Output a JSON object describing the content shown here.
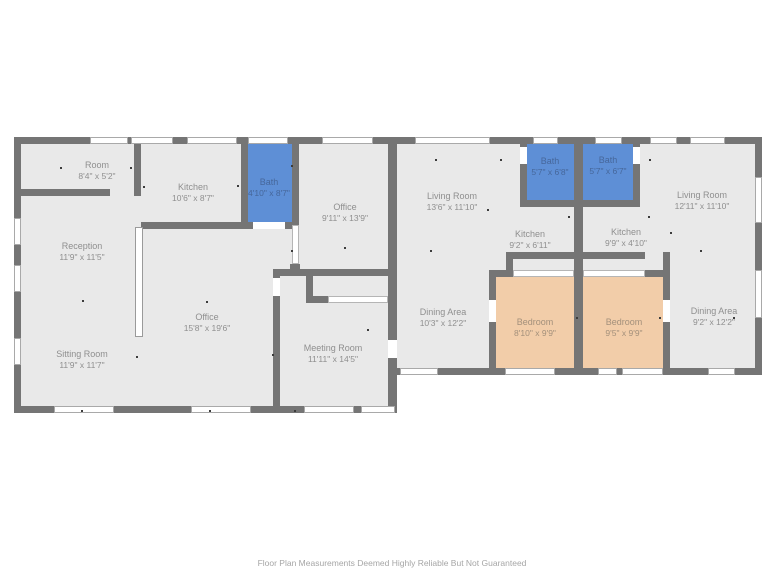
{
  "disclaimer": "Floor Plan Measurements Deemed Highly Reliable But Not Guaranteed",
  "colors": {
    "wall": "#757575",
    "floor": "#e9e9e9",
    "bath_fill": "#5e8fd6",
    "bedroom_fill": "#f2cda9",
    "label_text": "#8f8f8f",
    "bath_label_text": "#46679b",
    "bedroom_label_text": "#a3907b"
  },
  "rooms": [
    {
      "name": "Room",
      "dims": "8'4\" x 5'2\"",
      "x": 97,
      "y": 171,
      "style": "default"
    },
    {
      "name": "Kitchen",
      "dims": "10'6\" x 8'7\"",
      "x": 193,
      "y": 193,
      "style": "default"
    },
    {
      "name": "Bath",
      "dims": "4'10\" x 8'7\"",
      "x": 269,
      "y": 188,
      "style": "bath"
    },
    {
      "name": "Office",
      "dims": "9'11\" x 13'9\"",
      "x": 345,
      "y": 213,
      "style": "default"
    },
    {
      "name": "Reception",
      "dims": "11'9\" x 11'5\"",
      "x": 82,
      "y": 252,
      "style": "default"
    },
    {
      "name": "Office",
      "dims": "15'8\" x 19'6\"",
      "x": 207,
      "y": 323,
      "style": "default"
    },
    {
      "name": "Sitting Room",
      "dims": "11'9\" x 11'7\"",
      "x": 82,
      "y": 360,
      "style": "default"
    },
    {
      "name": "Meeting Room",
      "dims": "11'11\" x 14'5\"",
      "x": 333,
      "y": 354,
      "style": "default"
    },
    {
      "name": "Living Room",
      "dims": "13'6\" x 11'10\"",
      "x": 452,
      "y": 202,
      "style": "default"
    },
    {
      "name": "Bath",
      "dims": "5'7\" x 6'8\"",
      "x": 550,
      "y": 167,
      "style": "bath"
    },
    {
      "name": "Bath",
      "dims": "5'7\" x 6'7\"",
      "x": 608,
      "y": 166,
      "style": "bath"
    },
    {
      "name": "Living Room",
      "dims": "12'11\" x 11'10\"",
      "x": 702,
      "y": 201,
      "style": "default"
    },
    {
      "name": "Kitchen",
      "dims": "9'2\" x 6'11\"",
      "x": 530,
      "y": 240,
      "style": "default"
    },
    {
      "name": "Kitchen",
      "dims": "9'9\" x 4'10\"",
      "x": 626,
      "y": 238,
      "style": "default"
    },
    {
      "name": "Dining Area",
      "dims": "10'3\" x 12'2\"",
      "x": 443,
      "y": 318,
      "style": "default"
    },
    {
      "name": "Bedroom",
      "dims": "8'10\" x 9'9\"",
      "x": 535,
      "y": 328,
      "style": "bedroom"
    },
    {
      "name": "Bedroom",
      "dims": "9'5\" x 9'9\"",
      "x": 624,
      "y": 328,
      "style": "bedroom"
    },
    {
      "name": "Dining Area",
      "dims": "9'2\" x 12'2\"",
      "x": 714,
      "y": 317,
      "style": "default"
    }
  ],
  "markers": [
    [
      60,
      167
    ],
    [
      130,
      167
    ],
    [
      143,
      186
    ],
    [
      237,
      185
    ],
    [
      291,
      165
    ],
    [
      291,
      250
    ],
    [
      344,
      247
    ],
    [
      82,
      300
    ],
    [
      136,
      356
    ],
    [
      206,
      301
    ],
    [
      272,
      354
    ],
    [
      367,
      329
    ],
    [
      81,
      410
    ],
    [
      209,
      410
    ],
    [
      294,
      410
    ],
    [
      430,
      250
    ],
    [
      487,
      209
    ],
    [
      568,
      216
    ],
    [
      648,
      216
    ],
    [
      670,
      232
    ],
    [
      700,
      250
    ],
    [
      733,
      317
    ],
    [
      500,
      159
    ],
    [
      649,
      159
    ],
    [
      576,
      317
    ],
    [
      659,
      317
    ],
    [
      435,
      159
    ]
  ]
}
